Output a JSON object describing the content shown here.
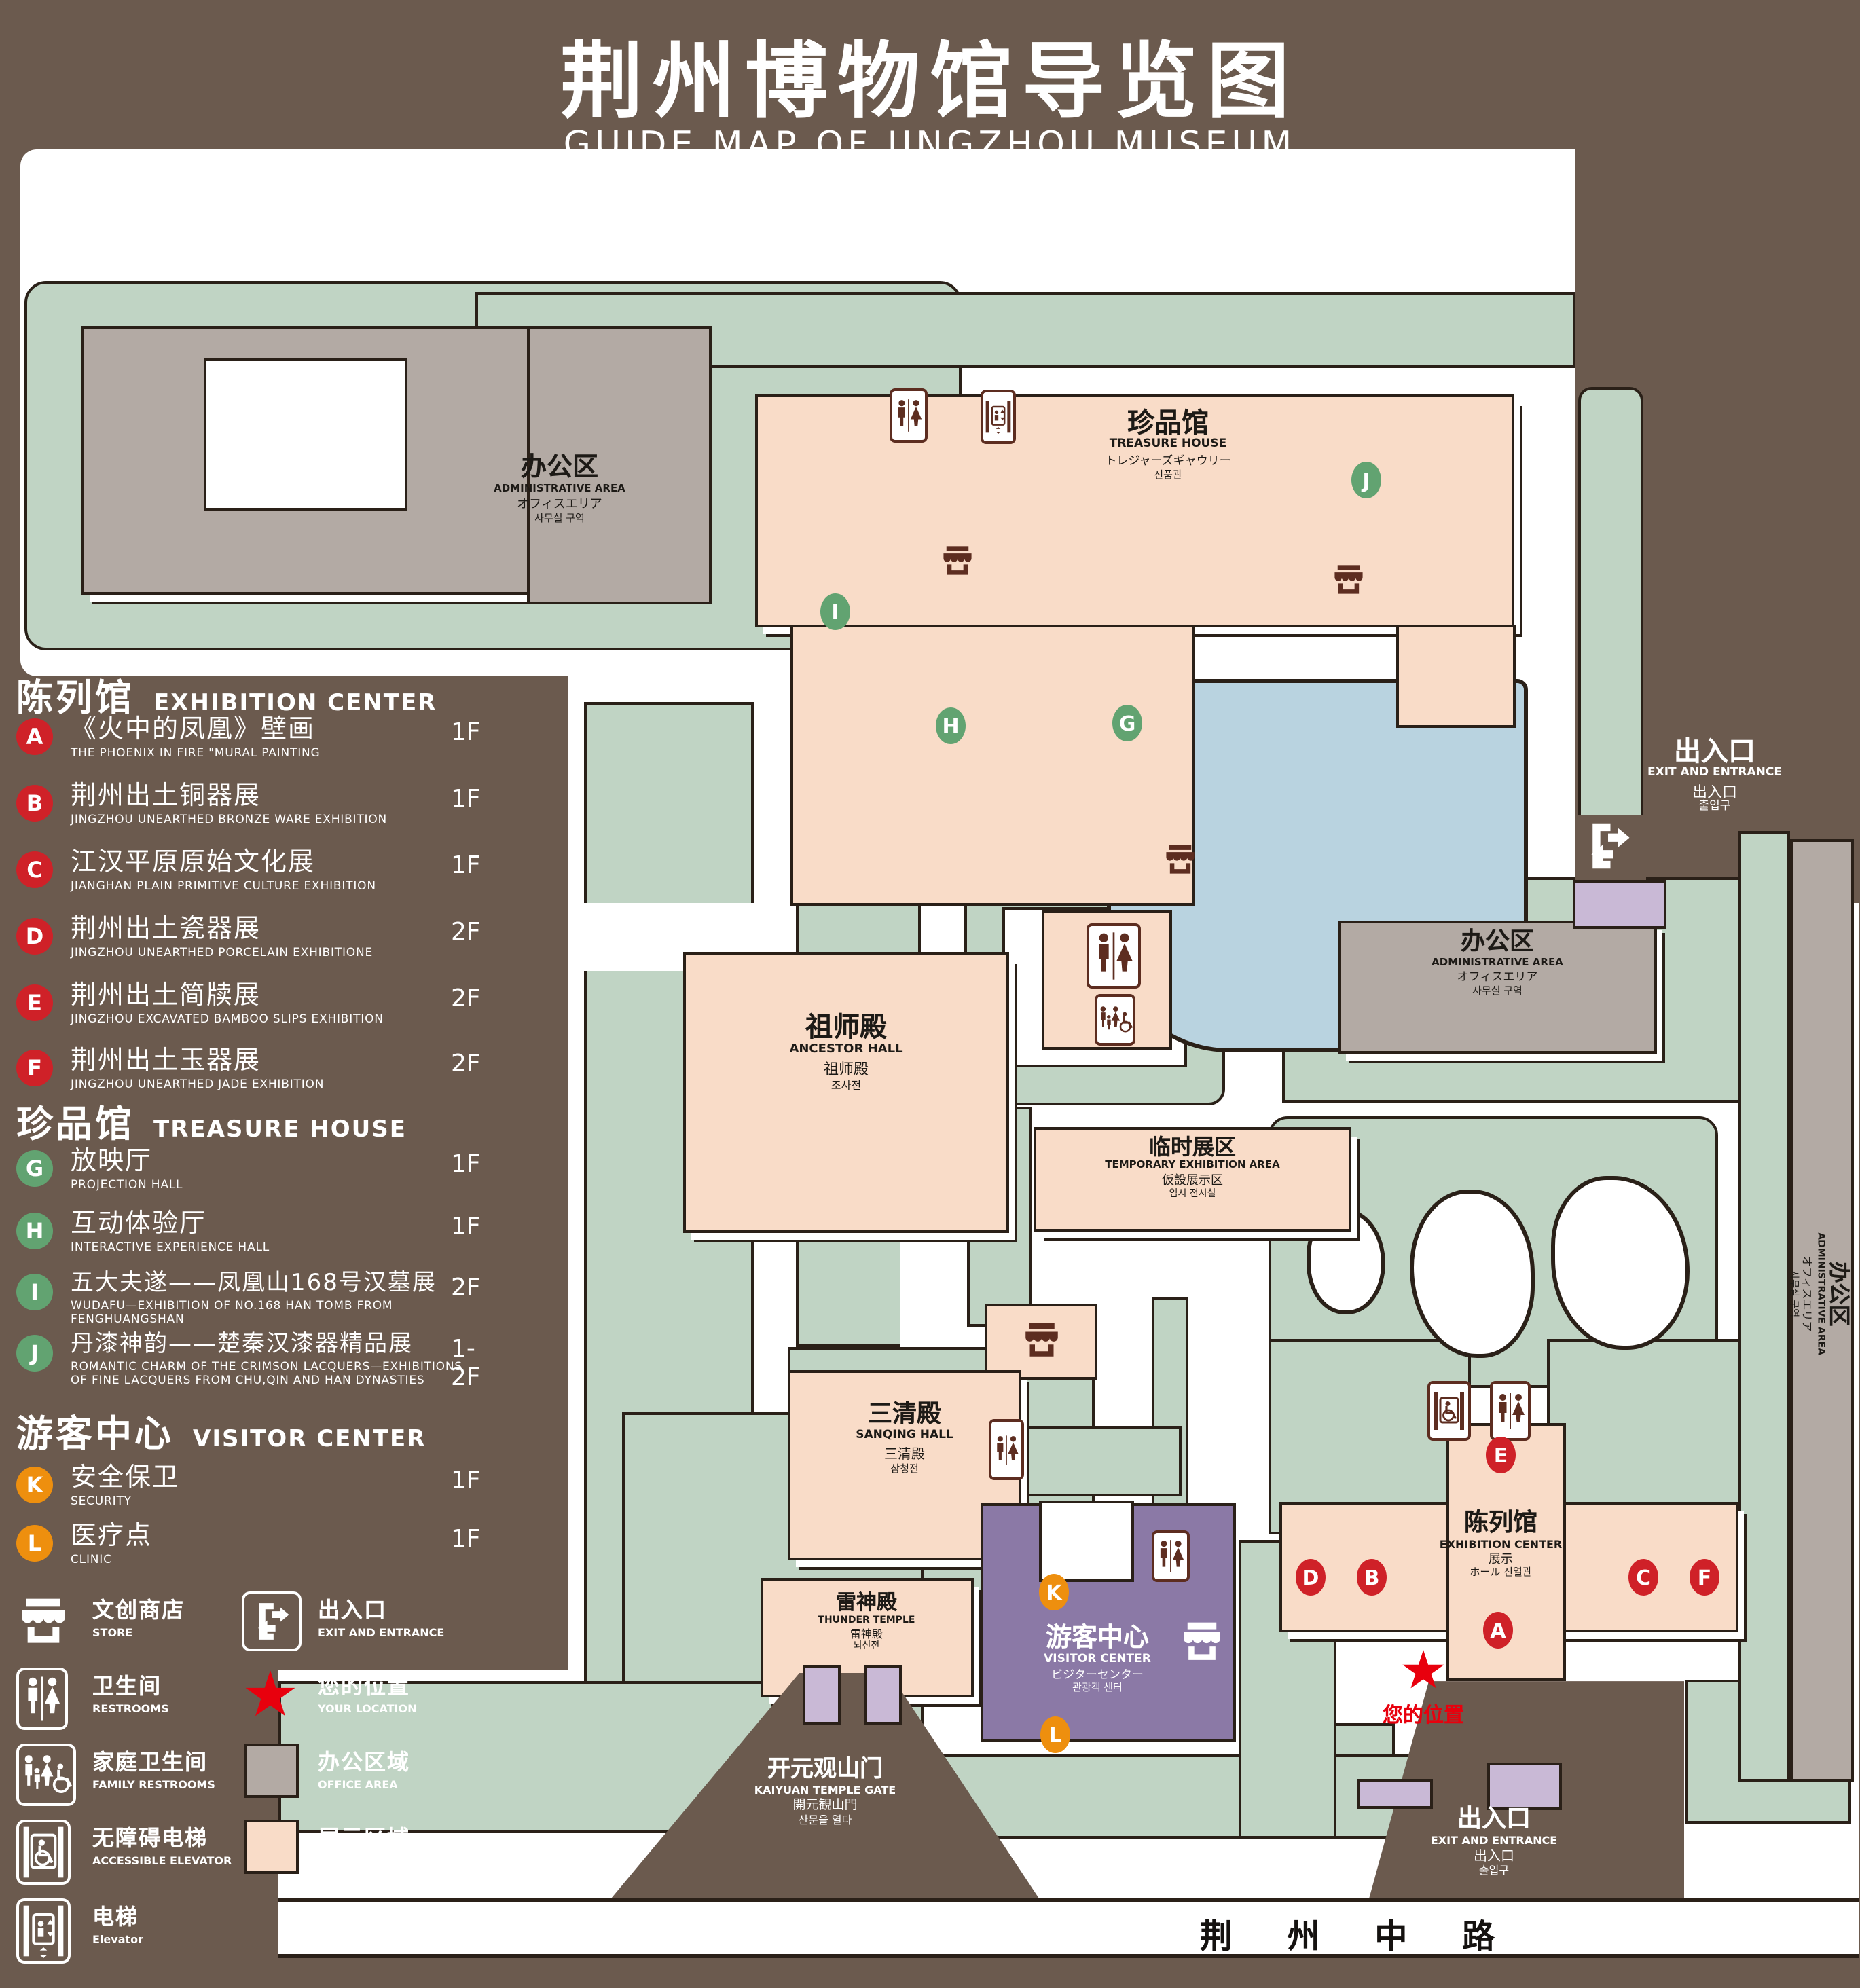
{
  "title": {
    "zh": "荆州博物馆导览图",
    "en": "GUIDE MAP OF JINGZHOU MUSEUM"
  },
  "legend": {
    "sections": [
      {
        "zh": "陈列馆",
        "en": "EXHIBITION CENTER",
        "items": [
          {
            "letter": "A",
            "zh": "《火中的凤凰》壁画",
            "en": "THE PHOENIX IN FIRE \"MURAL PAINTING",
            "floor": "1F"
          },
          {
            "letter": "B",
            "zh": "荆州出土铜器展",
            "en": "JINGZHOU UNEARTHED BRONZE WARE EXHIBITION",
            "floor": "1F"
          },
          {
            "letter": "C",
            "zh": "江汉平原原始文化展",
            "en": "JIANGHAN PLAIN PRIMITIVE CULTURE EXHIBITION",
            "floor": "1F"
          },
          {
            "letter": "D",
            "zh": "荆州出土瓷器展",
            "en": "JINGZHOU UNEARTHED PORCELAIN EXHIBITIONE",
            "floor": "2F"
          },
          {
            "letter": "E",
            "zh": "荆州出土简牍展",
            "en": "JINGZHOU EXCAVATED BAMBOO SLIPS EXHIBITION",
            "floor": "2F"
          },
          {
            "letter": "F",
            "zh": "荆州出土玉器展",
            "en": "JINGZHOU UNEARTHED JADE EXHIBITION",
            "floor": "2F"
          }
        ]
      },
      {
        "zh": "珍品馆",
        "en": "TREASURE HOUSE",
        "items": [
          {
            "letter": "G",
            "zh": "放映厅",
            "en": "PROJECTION HALL",
            "floor": "1F"
          },
          {
            "letter": "H",
            "zh": "互动体验厅",
            "en": "INTERACTIVE EXPERIENCE HALL",
            "floor": "1F"
          },
          {
            "letter": "I",
            "zh": "五大夫遂——凤凰山168号汉墓展",
            "en": "WUDAFU—EXHIBITION OF NO.168 HAN TOMB FROM FENGHUANGSHAN",
            "floor": "2F"
          },
          {
            "letter": "J",
            "zh": "丹漆神韵——楚秦汉漆器精品展",
            "en": "ROMANTIC CHARM OF THE CRIMSON LACQUERS—EXHIBITIONS OF FINE LACQUERS FROM CHU,QIN AND HAN DYNASTIES",
            "floor": "1-2F"
          }
        ]
      },
      {
        "zh": "游客中心",
        "en": "VISITOR CENTER",
        "items": [
          {
            "letter": "K",
            "zh": "安全保卫",
            "en": "SECURITY",
            "floor": "1F"
          },
          {
            "letter": "L",
            "zh": "医疗点",
            "en": "CLINIC",
            "floor": "1F"
          }
        ]
      }
    ],
    "symbols": [
      {
        "icon": "store-icon",
        "zh": "文创商店",
        "en": "STORE"
      },
      {
        "icon": "exit-entrance-icon",
        "zh": "出入口",
        "en": "EXIT AND ENTRANCE"
      },
      {
        "icon": "restrooms-icon",
        "zh": "卫生间",
        "en": "RESTROOMS"
      },
      {
        "icon": "your-location-star",
        "zh": "您的位置",
        "en": "YOUR LOCATION"
      },
      {
        "icon": "family-restrooms-icon",
        "zh": "家庭卫生间",
        "en": "FAMILY RESTROOMS"
      },
      {
        "icon": "office-area-swatch",
        "zh": "办公区域",
        "en": "OFFICE AREA"
      },
      {
        "icon": "accessible-elevator-icon",
        "zh": "无障碍电梯",
        "en": "ACCESSIBLE ELEVATOR"
      },
      {
        "icon": "display-area-swatch",
        "zh": "展示区域",
        "en": "DISPLAY AREA"
      },
      {
        "icon": "elevator-icon",
        "zh": "电梯",
        "en": "Elevator"
      }
    ]
  },
  "map": {
    "admin_tl": {
      "zh": "办公区",
      "en": "ADMINISTRATIVE AREA",
      "ja": "オフィスエリア",
      "ko": "사무실 구역"
    },
    "admin_right": {
      "zh": "办公区",
      "en": "ADMINISTRATIVE AREA",
      "ja": "オフィスエリア",
      "ko": "사무실 구역"
    },
    "admin_vert": {
      "zh": "办公区",
      "en": "ADMINISTRATIVE AREA",
      "ja": "オフィスエリア",
      "ko": "사무실 구역"
    },
    "treasure": {
      "zh": "珍品馆",
      "en": "TREASURE HOUSE",
      "ja": "トレジャーズギャウリー",
      "ko": "진품관"
    },
    "zushi": {
      "zh": "祖师殿",
      "en": "ANCESTOR HALL",
      "ja": "祖师殿",
      "ko": "조사전"
    },
    "sanqing": {
      "zh": "三清殿",
      "en": "SANQING HALL",
      "ja": "三清殿",
      "ko": "삼청전"
    },
    "leishen": {
      "zh": "雷神殿",
      "en": "THUNDER TEMPLE",
      "ja": "雷神殿",
      "ko": "뇌신전"
    },
    "linshi": {
      "zh": "临时展区",
      "en": "TEMPORARY EXHIBITION AREA",
      "ja": "仮設展示区",
      "ko": "임시 전시실"
    },
    "visitor": {
      "zh": "游客中心",
      "en": "VISITOR CENTER",
      "ja": "ビジターセンター",
      "ko": "관광객 센터"
    },
    "gate": {
      "zh": "开元观山门",
      "en": "KAIYUAN TEMPLE GATE",
      "ja": "開元観山門",
      "ko": "산문을 열다"
    },
    "exit_top": {
      "zh": "出入口",
      "en": "EXIT AND ENTRANCE",
      "ja": "出入口",
      "ko": "출입구"
    },
    "exit_bottom": {
      "zh": "出入口",
      "en": "EXIT AND ENTRANCE",
      "ja": "出入口",
      "ko": "출입구"
    },
    "your_location": "您的位置",
    "road": "荆 州 中 路",
    "markers": [
      {
        "letter": "A",
        "color": "red"
      },
      {
        "letter": "B",
        "color": "red"
      },
      {
        "letter": "C",
        "color": "red"
      },
      {
        "letter": "D",
        "color": "red"
      },
      {
        "letter": "E",
        "color": "red"
      },
      {
        "letter": "F",
        "color": "red"
      },
      {
        "letter": "G",
        "color": "green"
      },
      {
        "letter": "H",
        "color": "green"
      },
      {
        "letter": "I",
        "color": "green"
      },
      {
        "letter": "J",
        "color": "green"
      },
      {
        "letter": "K",
        "color": "orange"
      },
      {
        "letter": "L",
        "color": "orange"
      }
    ]
  },
  "colors": {
    "background": "#6b5a4e",
    "grass": "#c0d4c4",
    "display_area": "#f9dcc8",
    "office_area": "#b3aaa4",
    "water": "#b9d3e0",
    "visitor_center": "#8b79a6",
    "gate_purple": "#c9b9d6",
    "marker_red": "#cf2128",
    "marker_green": "#62a371",
    "marker_orange": "#ee8f0e",
    "icon_brown": "#5d2d20",
    "star_red": "#e8000d"
  }
}
